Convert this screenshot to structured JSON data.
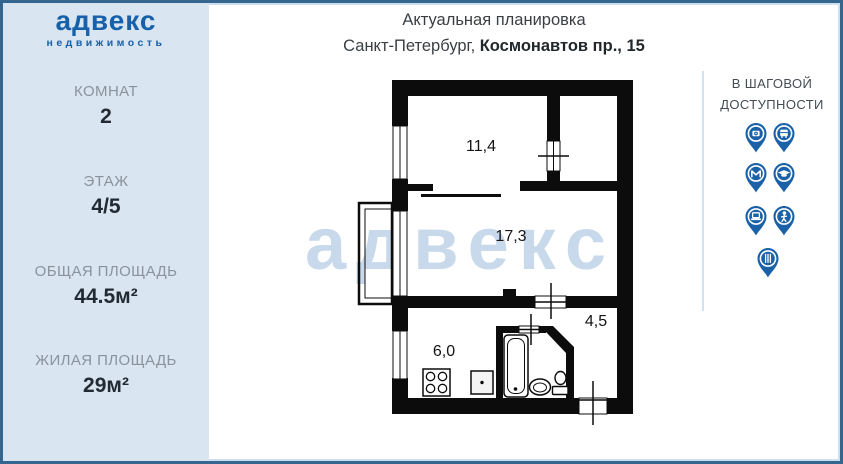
{
  "brand": {
    "name": "адвекс",
    "tagline": "недвижимость"
  },
  "header": {
    "line1": "Актуальная планировка",
    "city": "Санкт-Петербург, ",
    "address": "Космонавтов пр., 15"
  },
  "sidebar": {
    "stats": [
      {
        "label": "КОМНАТ",
        "value": "2"
      },
      {
        "label": "ЭТАЖ",
        "value": "4/5"
      },
      {
        "label": "ОБЩАЯ ПЛОЩАДЬ",
        "value": "44.5м²"
      },
      {
        "label": "ЖИЛАЯ ПЛОЩАДЬ",
        "value": "29м²"
      }
    ]
  },
  "floorplan": {
    "watermark": "адвекс",
    "rooms": [
      {
        "name": "room",
        "area": "11,4"
      },
      {
        "name": "living-room",
        "area": "17,3"
      },
      {
        "name": "hallway",
        "area": "4,5"
      },
      {
        "name": "kitchen",
        "area": "6,0"
      }
    ]
  },
  "walking": {
    "title_line1": "В ШАГОВОЙ",
    "title_line2": "ДОСТУПНОСТИ",
    "icons": [
      "camera-pin",
      "bus-pin",
      "metro-pin",
      "education-pin",
      "laptop-pin",
      "person-pin",
      "restaurant-pin"
    ]
  },
  "colors": {
    "accent_blue": "#1a61a8",
    "sidebar_bg": "#d9e5f1",
    "frame_border": "#34668f",
    "watermark": "#c7d9ea",
    "wall": "#0c0c0c"
  }
}
